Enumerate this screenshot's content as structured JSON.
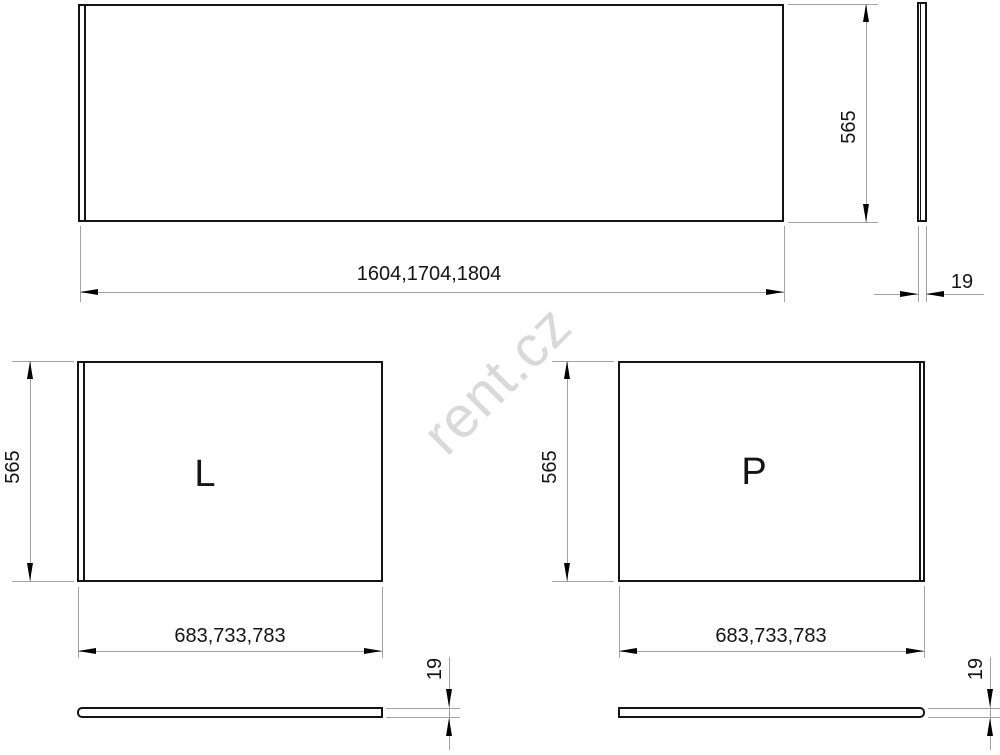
{
  "watermark": {
    "text": "rent.cz"
  },
  "colors": {
    "outline": "#141414",
    "dimension_lines": "#a3a3a3",
    "watermark": "#d9d9d9"
  },
  "front_panel": {
    "width_label": "1604,1704,1804",
    "height_label": "565",
    "thickness_label": "19"
  },
  "left_panel": {
    "letter": "L",
    "width_label": "683,733,783",
    "height_label": "565",
    "thickness_label": "19"
  },
  "right_panel": {
    "letter": "P",
    "width_label": "683,733,783",
    "height_label": "565",
    "thickness_label": "19"
  }
}
